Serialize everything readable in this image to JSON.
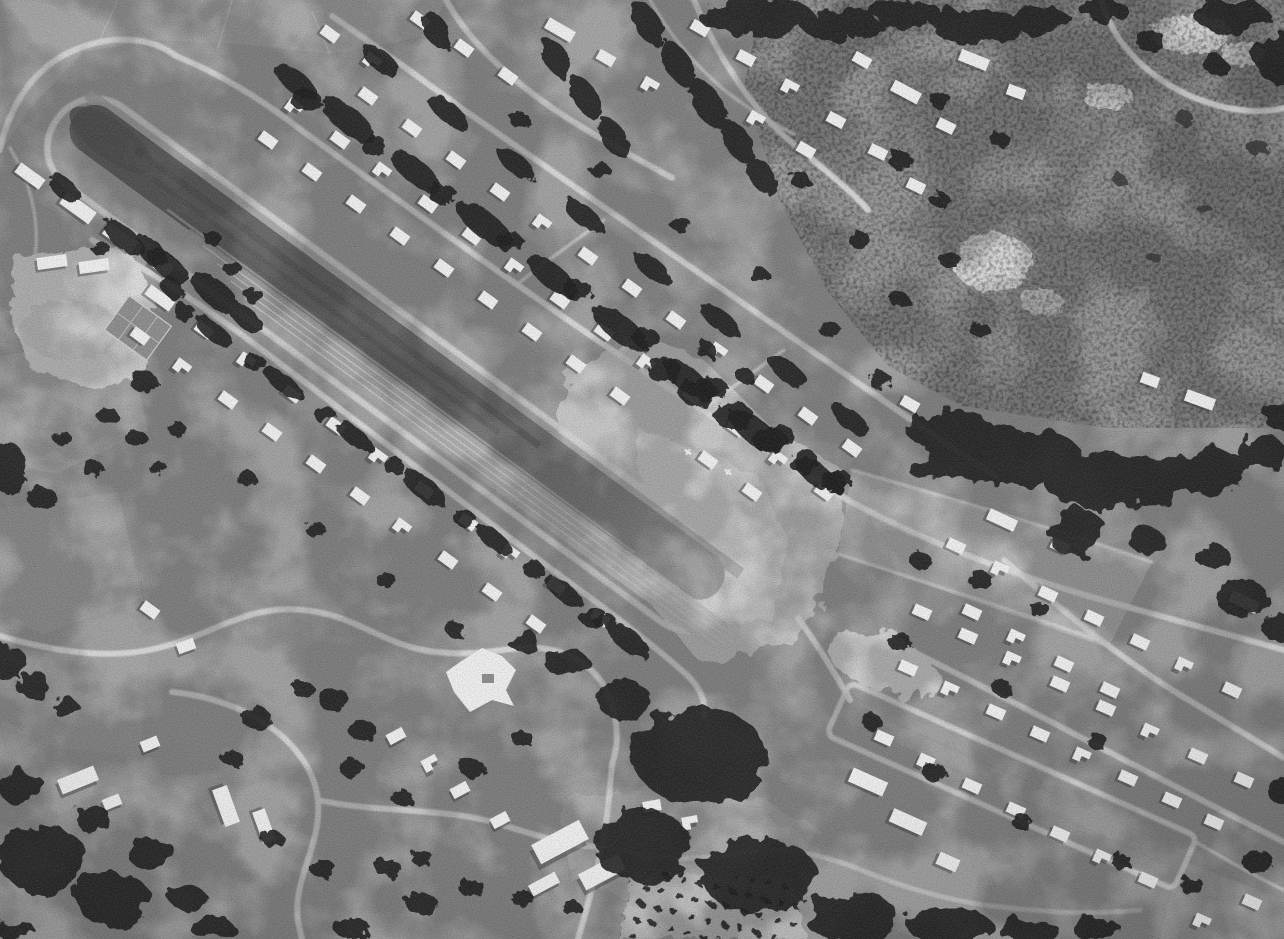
{
  "meta": {
    "type": "aerial-photograph",
    "color_mode": "black-and-white grayscale",
    "width_px": 1284,
    "height_px": 939,
    "description": "Vintage black-and-white aerial photograph of a small-town grass airstrip running diagonally from upper left toward the center, ringed by a perimeter road and flanked by suburban streets with houses and dark hedgerow tree lines; open hillside pasture fills the upper right, a dark forest band crosses center right, a second grass landing strip runs through housing at lower right, a dense neighborhood with large buildings sits at lower left, and a small orchard grid sits at bottom center."
  },
  "palette": {
    "base": "#a2a2a2",
    "field_light": "#c8c8c8",
    "field_bright": "#dedede",
    "hillside": "#9a9a9a",
    "road": "#dcdcdc",
    "tree": "#242424",
    "house": "#f1f1f1",
    "runway_dark": "#6a6a6a",
    "strip_mid": "#a2a2a2",
    "orchard_ground": "#c2c2c2",
    "orchard_dot": "#2c2c2c",
    "shadow": "#2e2e2e"
  },
  "scene": {
    "features": [
      {
        "name": "main-airstrip",
        "label": "Diagonal grass runway with rounded west end, worn wheel tracks and perimeter loop road"
      },
      {
        "name": "runway-apron",
        "label": "Light open apron and field at the runway's east end with small parked aircraft"
      },
      {
        "name": "northeast-residential-band",
        "label": "Three parallel streets of houses with dark perpendicular hedgerows northeast of the runway"
      },
      {
        "name": "southwest-residential-band",
        "label": "Streets of houses and hedgerows southwest of the runway"
      },
      {
        "name": "hillside-pasture",
        "label": "Broad mottled gray hillside pasture, upper right, with curving road at top corner"
      },
      {
        "name": "forest-band",
        "label": "Dense dark tree band crossing center right"
      },
      {
        "name": "second-grass-strip",
        "label": "Narrow grass strip bordered by roads cutting through housing, lower right"
      },
      {
        "name": "bottom-neighborhood",
        "label": "Dense neighborhood with long white buildings and winding roads, lower left"
      },
      {
        "name": "orchard",
        "label": "Regular grid of orchard trees, bottom center"
      },
      {
        "name": "schoolyard",
        "label": "Bright white yard with tennis court, left of runway"
      },
      {
        "name": "road-network",
        "label": "Light gray winding roads linking all areas"
      }
    ]
  }
}
